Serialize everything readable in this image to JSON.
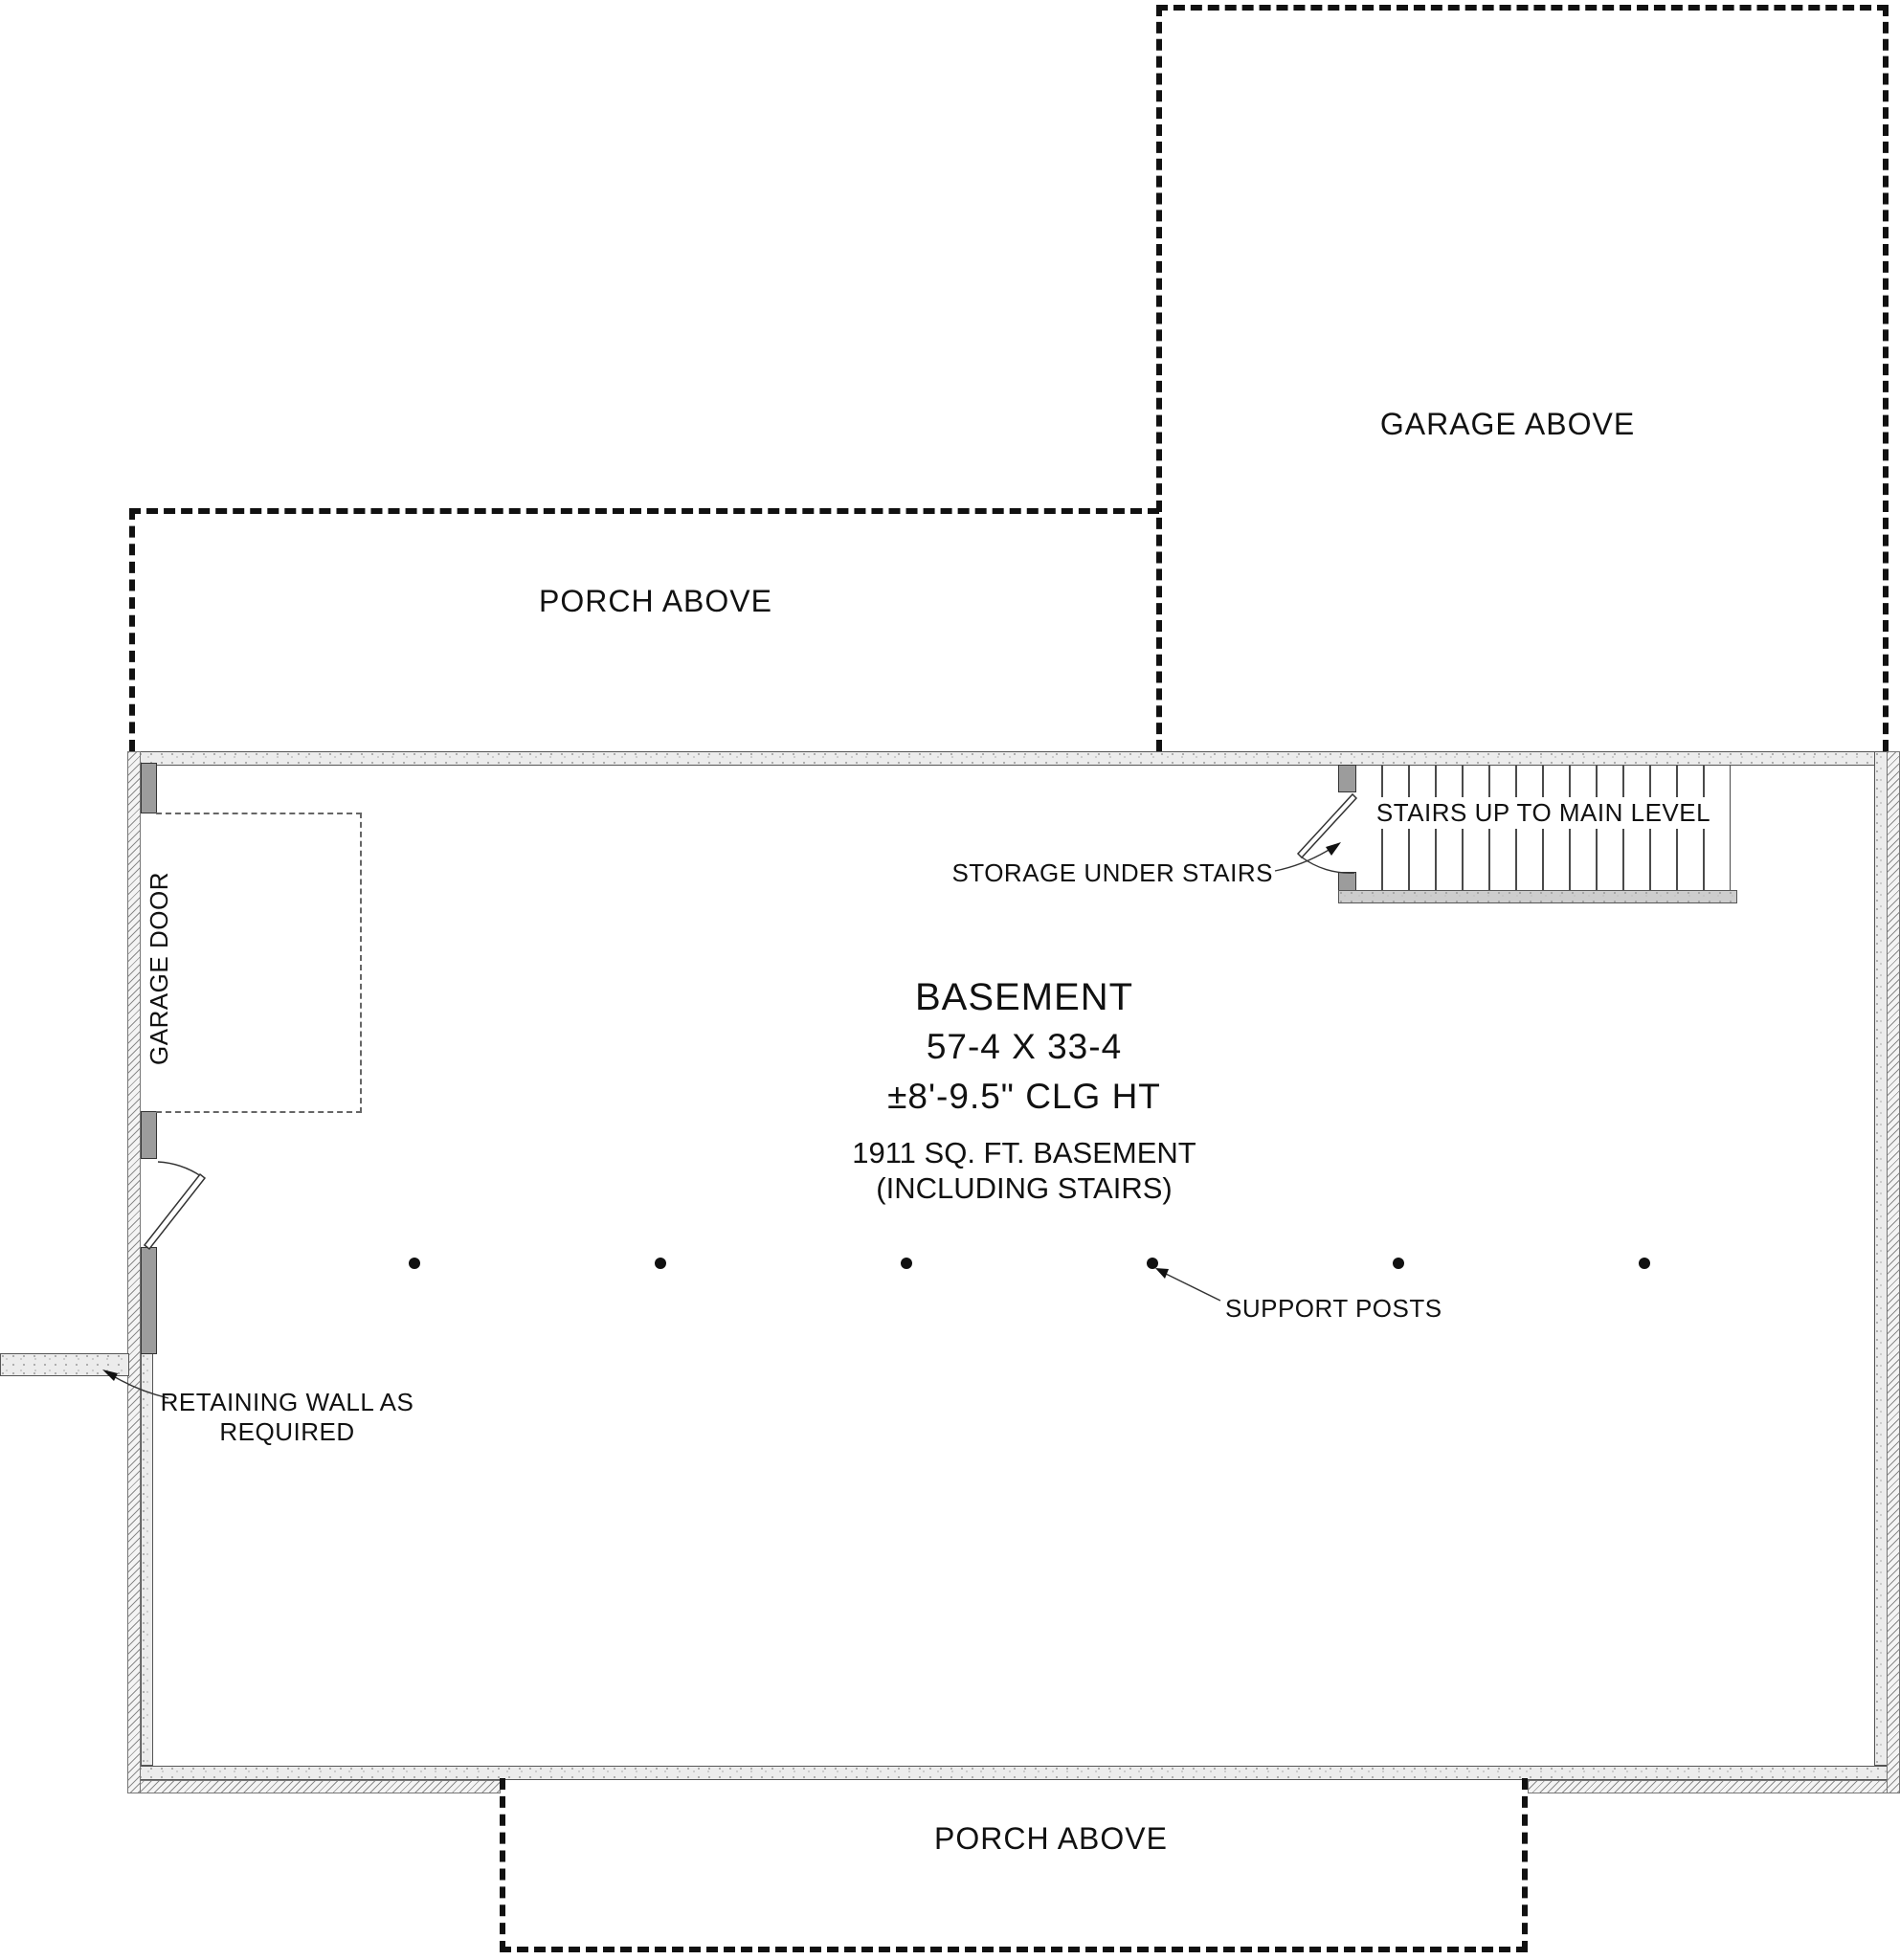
{
  "colors": {
    "line": "#111111",
    "wall_fill": "#ececec",
    "jamb_fill": "#9c9c9c"
  },
  "labels": {
    "garage_above": "GARAGE ABOVE",
    "porch_above_top": "PORCH ABOVE",
    "porch_above_bottom": "PORCH ABOVE",
    "stairs": "STAIRS UP TO MAIN LEVEL",
    "storage": "STORAGE UNDER STAIRS",
    "garage_door": "GARAGE DOOR",
    "support_posts": "SUPPORT POSTS",
    "retaining_wall_line1": "RETAINING WALL AS",
    "retaining_wall_line2": "REQUIRED"
  },
  "room": {
    "name": "BASEMENT",
    "dimensions": "57-4 X 33-4",
    "ceiling_height": "±8'-9.5\" CLG HT",
    "area_line1": "1911 SQ. FT. BASEMENT",
    "area_line2": "(INCLUDING STAIRS)"
  },
  "support_post_count": 6
}
